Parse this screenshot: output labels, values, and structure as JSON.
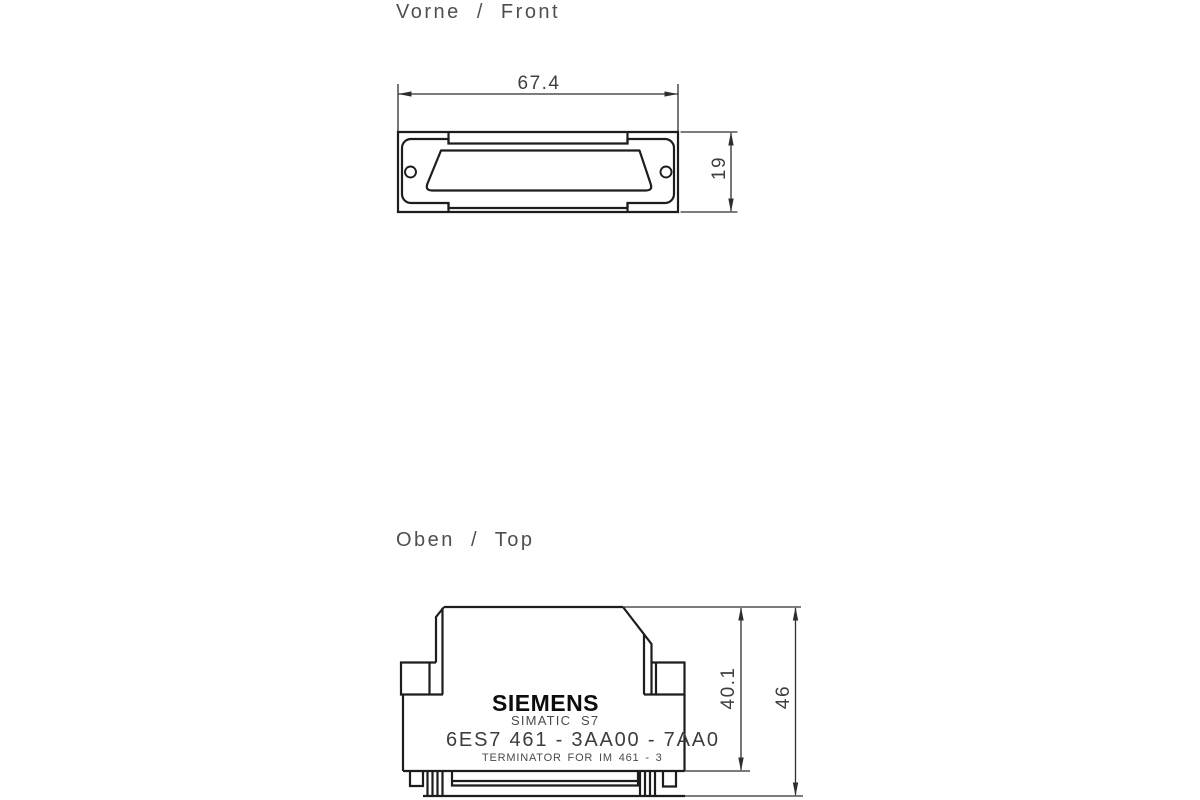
{
  "drawing": {
    "front_view": {
      "title": "Vorne  /  Front",
      "width_mm": "67.4",
      "height_mm": "19"
    },
    "top_view": {
      "title": "Oben  /  Top",
      "depth_to_body_mm": "40.1",
      "depth_total_mm": "46",
      "module_label": {
        "brand": "SIEMENS",
        "product_line": "SIMATIC  S7",
        "order_number": "6ES7 461 - 3AA00 - 7AA0",
        "description": "TERMINATOR FOR IM 461 - 3"
      }
    },
    "colors": {
      "background": "#ffffff",
      "outline": "#1d1d1d",
      "dimension_lines": "#2e2e2e",
      "annotation_text": "#4a4a4a",
      "brand_text": "#0c0c0c"
    }
  }
}
